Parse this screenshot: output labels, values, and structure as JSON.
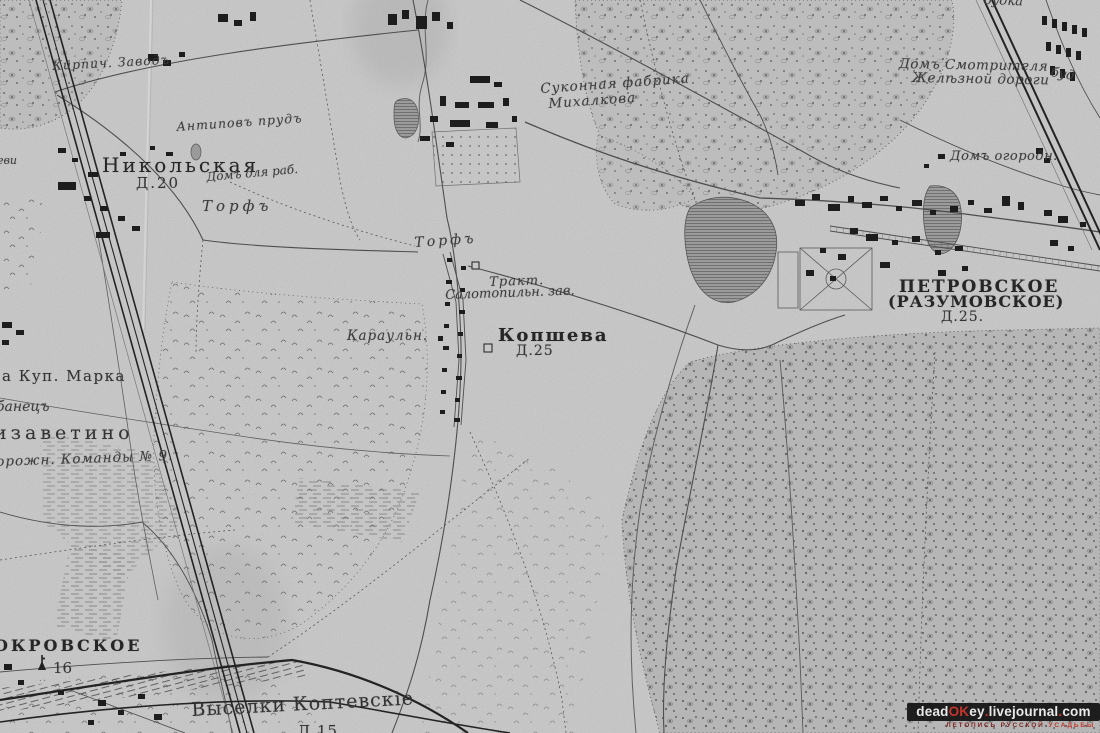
{
  "colors": {
    "paper": "#c7c7c7",
    "ink": "#2e2e2e",
    "ink_light": "#555555",
    "water": "#9b9b9b",
    "watermark_bg": "#121212",
    "watermark_white": "#e9e9e9",
    "watermark_red": "#c5342c",
    "tagline_dark_red": "#7d2420",
    "tagline_bright_red": "#c0392b"
  },
  "labels": {
    "kirpich_zavod": "Кирпич. Заводъ",
    "budka_top": "будка",
    "dom_smotritelya_1": "Домъ Смотрителя",
    "dom_smotritelya_2": "Желѣзной дороги",
    "bud": "буд",
    "sukonnaya_1": "Суконная фабрика",
    "sukonnaya_2": "Михалкова",
    "antipov_prud": "Антиповъ прудъ",
    "dom_ogorodnika": "Домъ огородн.",
    "nikolskaya": "Никольская",
    "nikolskaya_d": "Д.20",
    "dom_dlya_rab": "Домъ для раб.",
    "torf_1": "Торфъ",
    "torf_2": "Торфъ",
    "petrovskoe_1": "ПЕТРОВСКОЕ",
    "petrovskoe_2": "(РАЗУМОВСКОЕ)",
    "petrovskoe_d": "Д.25.",
    "trakt_1": "Тракт.",
    "trakt_2": "Салотопильн. зав.",
    "karauln": "Караульн.",
    "kopsheva": "Копшева",
    "kopsheva_d": "Д.25",
    "kup_marka": "а Куп. Марка",
    "banets": "банецъ",
    "elizavetino": "изаветино",
    "dorozhn_komanda": "орожн. Команды № 9.",
    "pokrovskoe": "ОКРОВСКОЕ",
    "pokrovskoe_num": "16",
    "vyselki": "Выселки Коптевскіе",
    "vyselki_d": "Д.15",
    "left_edge_partial": "еви"
  },
  "icons": {
    "church-icon": "church-spire-with-cross"
  },
  "watermark": {
    "segments": [
      {
        "text": "dead",
        "color": "#e9e9e9"
      },
      {
        "text": "OK",
        "color": "#c5342c"
      },
      {
        "text": "ey",
        "color": "#e9e9e9"
      },
      {
        "text": ".",
        "color": "#c5342c"
      },
      {
        "text": "livejournal",
        "color": "#e9e9e9"
      },
      {
        "text": ".",
        "color": "#c5342c"
      },
      {
        "text": "com",
        "color": "#e9e9e9"
      }
    ],
    "tagline": [
      {
        "text": "ЛЕТОПИСЬ РУССКОЙ",
        "color": "#7d2420"
      },
      {
        "text": "УСАДЬБЫ",
        "color": "#c0392b"
      }
    ]
  }
}
